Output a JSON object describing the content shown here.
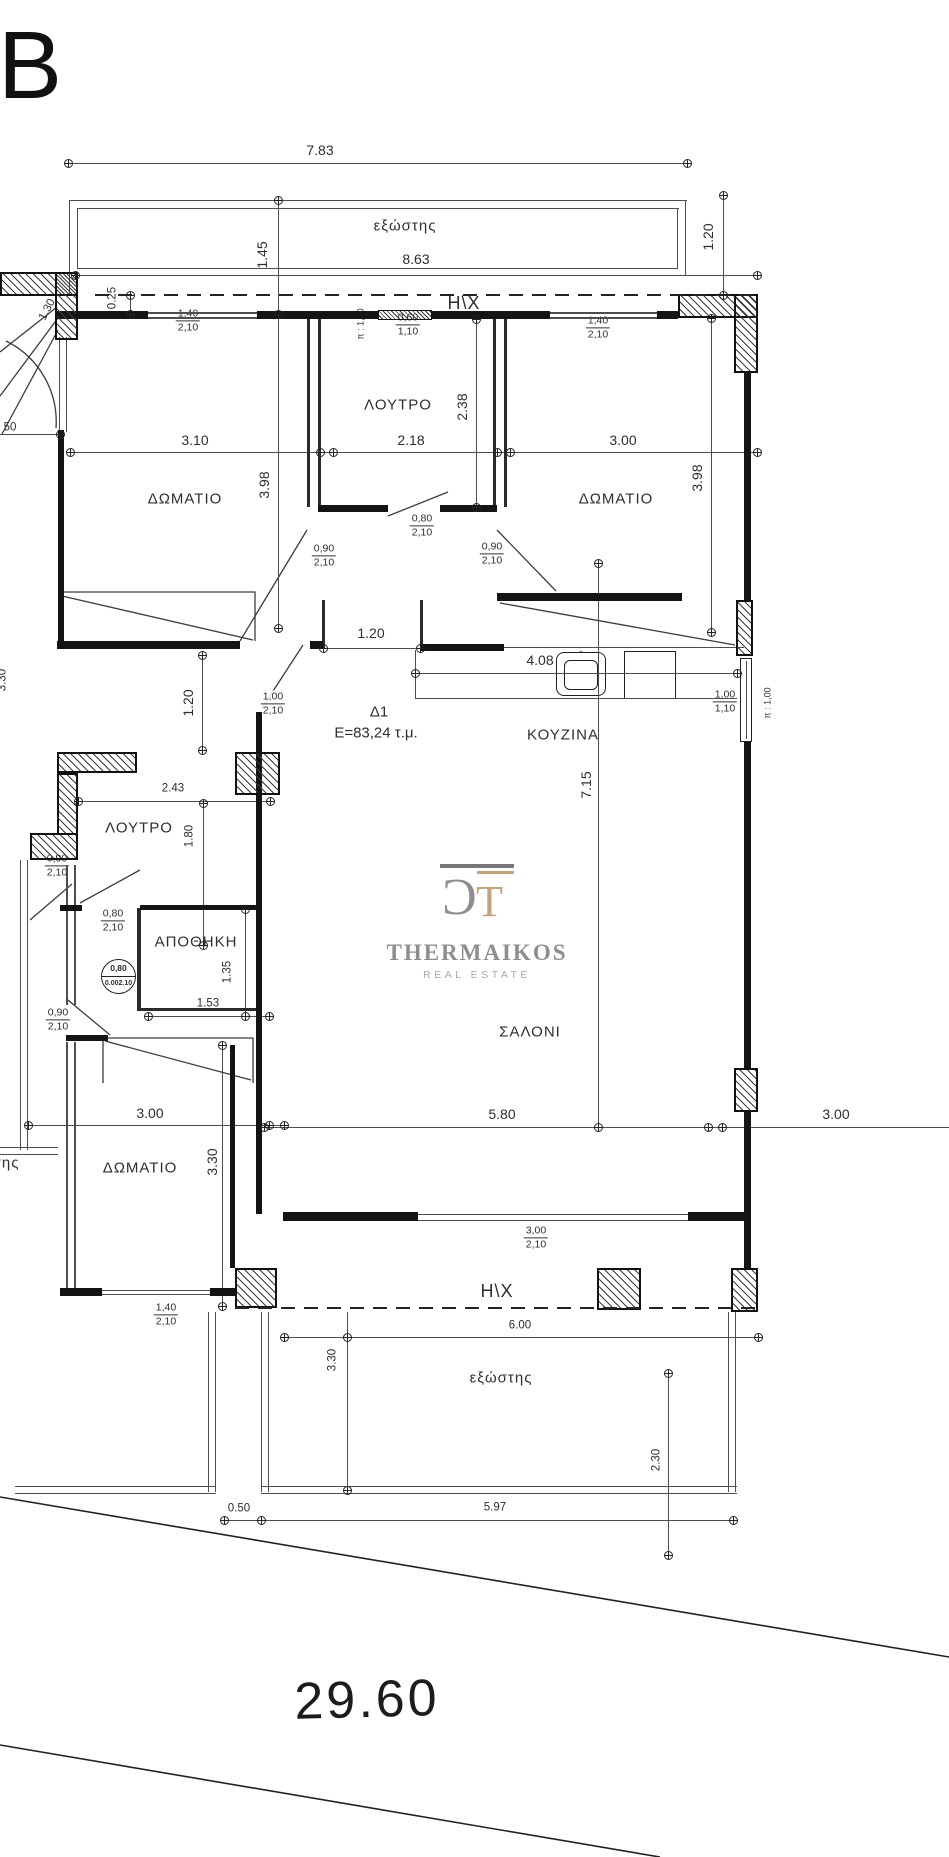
{
  "sheet": {
    "letter": "B"
  },
  "apartment": {
    "id": "Δ1",
    "area_label": "E=83,24 τ.μ."
  },
  "plot": {
    "frontage": "29.60"
  },
  "logo": {
    "name": "THERMAIKOS",
    "subtitle": "REAL ESTATE",
    "monogram_left": "C",
    "monogram_right": "T",
    "colors": {
      "gray": "#8e8e90",
      "tan": "#c2a47c"
    }
  },
  "level_marker": {
    "top": "0,80",
    "bottom_left": "0.00",
    "bottom_right": "2.10"
  },
  "annotations": [
    {
      "name": "sheet-letter",
      "text": "B",
      "x": 30,
      "y": 66,
      "cls": "sheet"
    },
    {
      "name": "dim-7-83",
      "text": "7.83",
      "x": 320,
      "y": 150,
      "cls": "dim"
    },
    {
      "name": "label-balcony-top",
      "text": "εξώστης",
      "x": 405,
      "y": 226,
      "cls": "room sm"
    },
    {
      "name": "dim-8-63",
      "text": "8.63",
      "x": 416,
      "y": 259,
      "cls": "dim"
    },
    {
      "name": "dim-1-45",
      "text": "1.45",
      "x": 262,
      "y": 255,
      "cls": "dim rot"
    },
    {
      "name": "dim-1-20-top-right",
      "text": "1.20",
      "x": 708,
      "y": 237,
      "cls": "dim rot"
    },
    {
      "name": "label-hx-top",
      "text": "H\\X",
      "x": 464,
      "y": 303,
      "cls": "hx"
    },
    {
      "name": "dim-0-25",
      "text": "0.25",
      "x": 113,
      "y": 298,
      "cls": "dim rot sm2"
    },
    {
      "name": "dim-pi-1-00-top",
      "text": "π : 1,00",
      "x": 361,
      "y": 324,
      "cls": "tiny rot"
    },
    {
      "name": "dim-1-30-stair",
      "text": "1.30",
      "x": 48,
      "y": 310,
      "cls": "dim sm2 rot65"
    },
    {
      "name": "room-bedroom-1",
      "text": "ΔΩΜΑΤΙΟ",
      "x": 185,
      "y": 499,
      "cls": "room"
    },
    {
      "name": "dim-3-10",
      "text": "3.10",
      "x": 195,
      "y": 440,
      "cls": "dim"
    },
    {
      "name": "dim-3-98-left",
      "text": "3.98",
      "x": 264,
      "y": 485,
      "cls": "dim rot"
    },
    {
      "name": "room-bath-top",
      "text": "ΛΟΥΤΡΟ",
      "x": 398,
      "y": 405,
      "cls": "room sm"
    },
    {
      "name": "dim-2-18",
      "text": "2.18",
      "x": 411,
      "y": 440,
      "cls": "dim"
    },
    {
      "name": "dim-2-38",
      "text": "2.38",
      "x": 462,
      "y": 407,
      "cls": "dim rot"
    },
    {
      "name": "room-bedroom-2",
      "text": "ΔΩΜΑΤΙΟ",
      "x": 616,
      "y": 499,
      "cls": "room"
    },
    {
      "name": "dim-3-00-top",
      "text": "3.00",
      "x": 623,
      "y": 440,
      "cls": "dim"
    },
    {
      "name": "dim-3-98-right",
      "text": "3.98",
      "x": 697,
      "y": 478,
      "cls": "dim rot"
    },
    {
      "name": "dim-1-20-hall",
      "text": "1.20",
      "x": 371,
      "y": 633,
      "cls": "dim"
    },
    {
      "name": "dim-4-08",
      "text": "4.08",
      "x": 540,
      "y": 660,
      "cls": "dim"
    },
    {
      "name": "room-kitchen",
      "text": "ΚΟΥΖΙΝΑ",
      "x": 563,
      "y": 735,
      "cls": "room sm"
    },
    {
      "name": "dim-pi-1-00-right",
      "text": "π : 1,00",
      "x": 768,
      "y": 703,
      "cls": "tiny rot"
    },
    {
      "name": "dim-1-20-left",
      "text": "1.20",
      "x": 188,
      "y": 703,
      "cls": "dim rot"
    },
    {
      "name": "apartment-id",
      "text": "Δ1",
      "x": 379,
      "y": 712,
      "cls": "big"
    },
    {
      "name": "apartment-area",
      "text": "E=83,24 τ.μ.",
      "x": 376,
      "y": 733,
      "cls": "big"
    },
    {
      "name": "dim-2-43",
      "text": "2.43",
      "x": 173,
      "y": 789,
      "cls": "dim sm2"
    },
    {
      "name": "room-bath-2",
      "text": "ΛΟΥΤΡΟ",
      "x": 139,
      "y": 828,
      "cls": "room sm"
    },
    {
      "name": "dim-1-80",
      "text": "1.80",
      "x": 190,
      "y": 836,
      "cls": "dim rot sm2"
    },
    {
      "name": "room-storage",
      "text": "ΑΠΟΘΗΚΗ",
      "x": 196,
      "y": 942,
      "cls": "room sm"
    },
    {
      "name": "dim-1-35",
      "text": "1.35",
      "x": 228,
      "y": 972,
      "cls": "dim rot sm2"
    },
    {
      "name": "dim-1-53",
      "text": "1.53",
      "x": 208,
      "y": 1004,
      "cls": "dim sm2"
    },
    {
      "name": "dim-3-00-lower-left",
      "text": "3.00",
      "x": 150,
      "y": 1113,
      "cls": "dim"
    },
    {
      "name": "room-bedroom-3",
      "text": "ΔΩΜΑΤΙΟ",
      "x": 140,
      "y": 1168,
      "cls": "room sm"
    },
    {
      "name": "dim-3-30-left",
      "text": "3.30",
      "x": 212,
      "y": 1162,
      "cls": "dim rot"
    },
    {
      "name": "room-living",
      "text": "ΣΑΛΟΝΙ",
      "x": 530,
      "y": 1032,
      "cls": "room"
    },
    {
      "name": "dim-5-80",
      "text": "5.80",
      "x": 502,
      "y": 1114,
      "cls": "dim"
    },
    {
      "name": "dim-3-00-right",
      "text": "3.00",
      "x": 836,
      "y": 1114,
      "cls": "dim"
    },
    {
      "name": "dim-7-15",
      "text": "7.15",
      "x": 586,
      "y": 785,
      "cls": "dim rot"
    },
    {
      "name": "label-hx-bottom",
      "text": "H\\X",
      "x": 497,
      "y": 1291,
      "cls": "hx"
    },
    {
      "name": "dim-6-00",
      "text": "6.00",
      "x": 520,
      "y": 1326,
      "cls": "dim sm2"
    },
    {
      "name": "label-balcony-bottom",
      "text": "εξώστης",
      "x": 501,
      "y": 1378,
      "cls": "room sm"
    },
    {
      "name": "dim-3-30-balcony",
      "text": "3.30",
      "x": 333,
      "y": 1360,
      "cls": "dim rot sm2"
    },
    {
      "name": "dim-2-30",
      "text": "2.30",
      "x": 657,
      "y": 1460,
      "cls": "dim rot sm2"
    },
    {
      "name": "dim-0-50",
      "text": "0.50",
      "x": 239,
      "y": 1509,
      "cls": "dim sm2"
    },
    {
      "name": "dim-5-97",
      "text": "5.97",
      "x": 495,
      "y": 1508,
      "cls": "dim sm2"
    },
    {
      "name": "dim-29-60",
      "text": "29.60",
      "x": 367,
      "y": 1700,
      "cls": "plot"
    },
    {
      "name": "label-balcony-left-clipped",
      "text": "εξώστης",
      "x": -12,
      "y": 1163,
      "cls": "room sm"
    },
    {
      "name": "dim-3-30-edge",
      "text": "3.30",
      "x": 3,
      "y": 680,
      "cls": "dim rot sm2"
    },
    {
      "name": "dim-50-edge",
      "text": "50",
      "x": 10,
      "y": 428,
      "cls": "dim sm2"
    }
  ],
  "opening_tags": [
    {
      "name": "window-tag-1-40-a",
      "top": "1,40",
      "bottom": "2,10",
      "x": 188,
      "y": 321
    },
    {
      "name": "window-tag-0-60",
      "top": "0,60",
      "bottom": "1,10",
      "x": 408,
      "y": 325
    },
    {
      "name": "window-tag-1-40-b",
      "top": "1,40",
      "bottom": "2,10",
      "x": 598,
      "y": 328
    },
    {
      "name": "door-tag-0-80-a",
      "top": "0,80",
      "bottom": "2,10",
      "x": 422,
      "y": 526
    },
    {
      "name": "door-tag-0-90-a",
      "top": "0,90",
      "bottom": "2,10",
      "x": 324,
      "y": 556
    },
    {
      "name": "door-tag-0-90-b",
      "top": "0,90",
      "bottom": "2,10",
      "x": 492,
      "y": 554
    },
    {
      "name": "window-tag-1-00",
      "top": "1,00",
      "bottom": "1,10",
      "x": 725,
      "y": 702
    },
    {
      "name": "door-tag-1-00",
      "top": "1,00",
      "bottom": "2,10",
      "x": 273,
      "y": 704
    },
    {
      "name": "door-tag-0-80-b",
      "top": "0,80",
      "bottom": "2,10",
      "x": 113,
      "y": 921
    },
    {
      "name": "door-tag-0-90-c",
      "top": "0,90",
      "bottom": "2,10",
      "x": 57,
      "y": 866
    },
    {
      "name": "door-tag-0-90-d",
      "top": "0,90",
      "bottom": "2,10",
      "x": 58,
      "y": 1020
    },
    {
      "name": "window-tag-3-00",
      "top": "3,00",
      "bottom": "2,10",
      "x": 536,
      "y": 1238
    },
    {
      "name": "window-tag-1-40-c",
      "top": "1,40",
      "bottom": "2,10",
      "x": 166,
      "y": 1315
    }
  ]
}
